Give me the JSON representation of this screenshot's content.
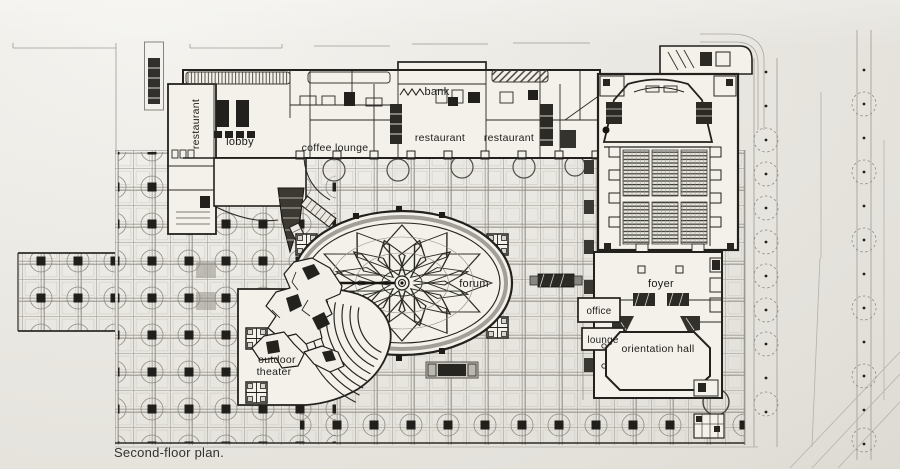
{
  "plan": {
    "caption": "Second-floor plan.",
    "rooms": {
      "restaurant_left": {
        "label": "restaurant"
      },
      "lobby": {
        "label": "lobby"
      },
      "coffee_lounge": {
        "label": "coffee lounge"
      },
      "bank": {
        "label": "bank"
      },
      "restaurant_center": {
        "label": "restaurant"
      },
      "restaurant_right": {
        "label": "restaurant"
      },
      "forum": {
        "label": "forum"
      },
      "foyer": {
        "label": "foyer"
      },
      "office": {
        "label": "office"
      },
      "lounge": {
        "label": "lounge"
      },
      "orientation_hall": {
        "label": "orientation hall"
      },
      "outdoor_theater_line1": {
        "label": "outdoor"
      },
      "outdoor_theater_line2": {
        "label": "theater"
      }
    },
    "colors": {
      "paper": "#e9e7e1",
      "building_fill": "#f3f1ea",
      "ink": "#23211d",
      "ink_mid": "#55534c",
      "ink_light": "#8f8c84",
      "grid_line": "#aeaba2"
    }
  }
}
